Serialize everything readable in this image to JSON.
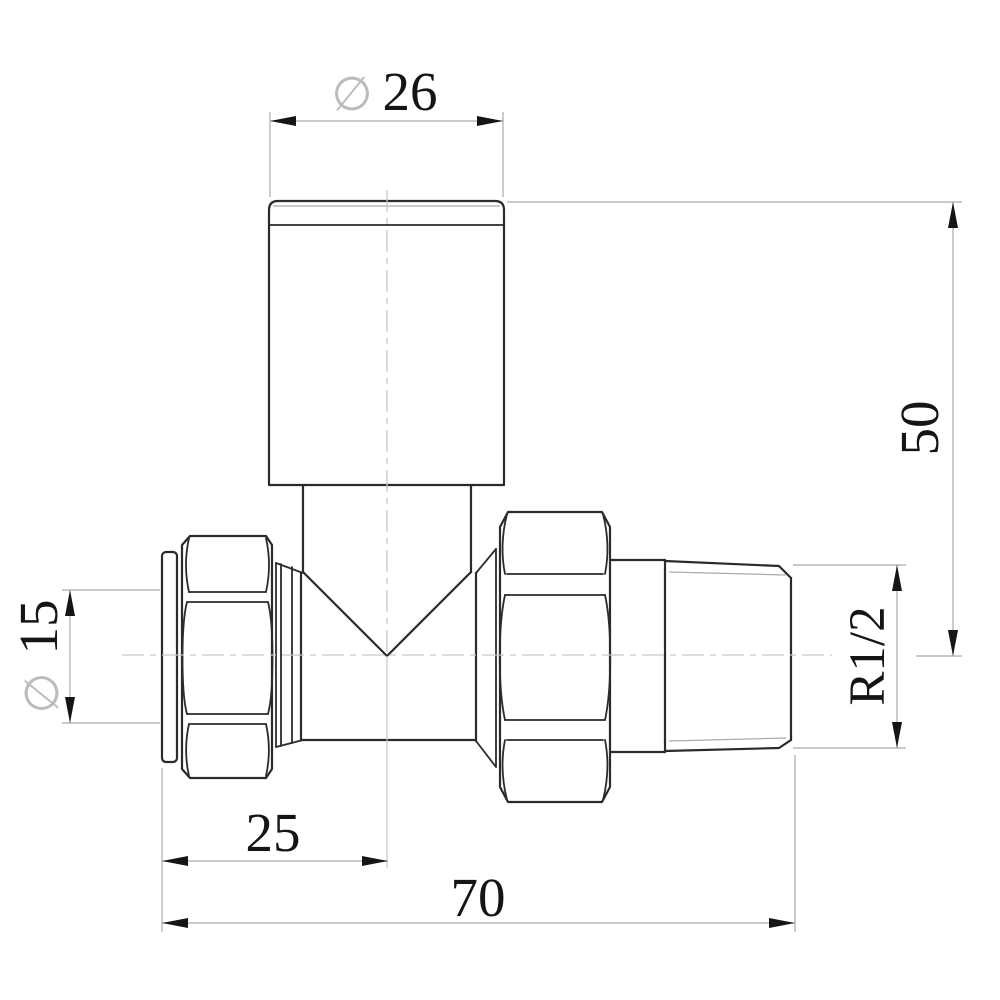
{
  "drawing": {
    "background_color": "#ffffff",
    "outline_color": "#2b2b2b",
    "thin_line_color": "#aaaaaa",
    "centerline_color": "#c6c6c6",
    "dimension_text_color": "#151515",
    "diameter_symbol_color": "#bcbcbc",
    "dimensions": {
      "knob_diameter": {
        "symbol": "∅",
        "value": "26"
      },
      "inlet_diameter": {
        "symbol": "∅",
        "value": "15"
      },
      "height_to_center": {
        "value": "50"
      },
      "thread_size": {
        "value": "R1/2"
      },
      "center_offset": {
        "value": "25"
      },
      "overall_length": {
        "value": "70"
      }
    }
  }
}
